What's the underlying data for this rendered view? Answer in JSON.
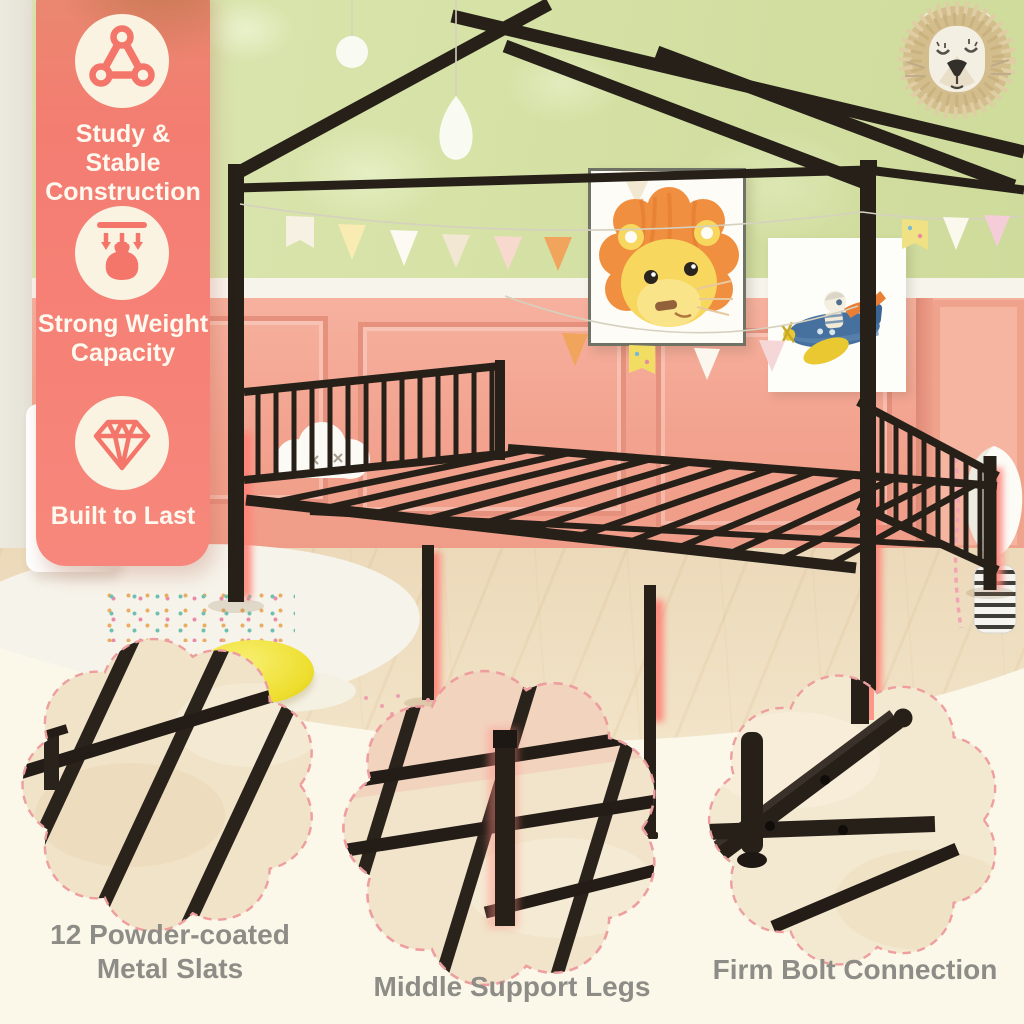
{
  "panel": {
    "features": [
      {
        "icon": "triangle-link-icon",
        "title": "Study & Stable Construction"
      },
      {
        "icon": "weight-capacity-icon",
        "title": "Strong Weight Capacity"
      },
      {
        "icon": "diamond-icon",
        "title": "Built to Last"
      }
    ]
  },
  "callouts": [
    {
      "icon": "metal-slats-photo",
      "label": "12 Powder-coated\nMetal Slats"
    },
    {
      "icon": "support-leg-photo",
      "label": "Middle Support Legs"
    },
    {
      "icon": "bolt-connection-photo",
      "label": "Firm Bolt Connection"
    }
  ],
  "colors": {
    "accent_coral": "#f4786e",
    "panel_top_shade": "#cc8f66",
    "icon_circle_ivory": "#faf3e2",
    "label_gray": "#8e8c87",
    "leg_glow_pink": "#ff8277",
    "metal_black": "#262019",
    "wall_green": "#d6e2a6",
    "wainscot_salmon": "#f2a28e",
    "floor_wood": "#ecd9ba",
    "cream_background": "#fbf7e9",
    "flower_border_pink": "#ee9e9e"
  }
}
